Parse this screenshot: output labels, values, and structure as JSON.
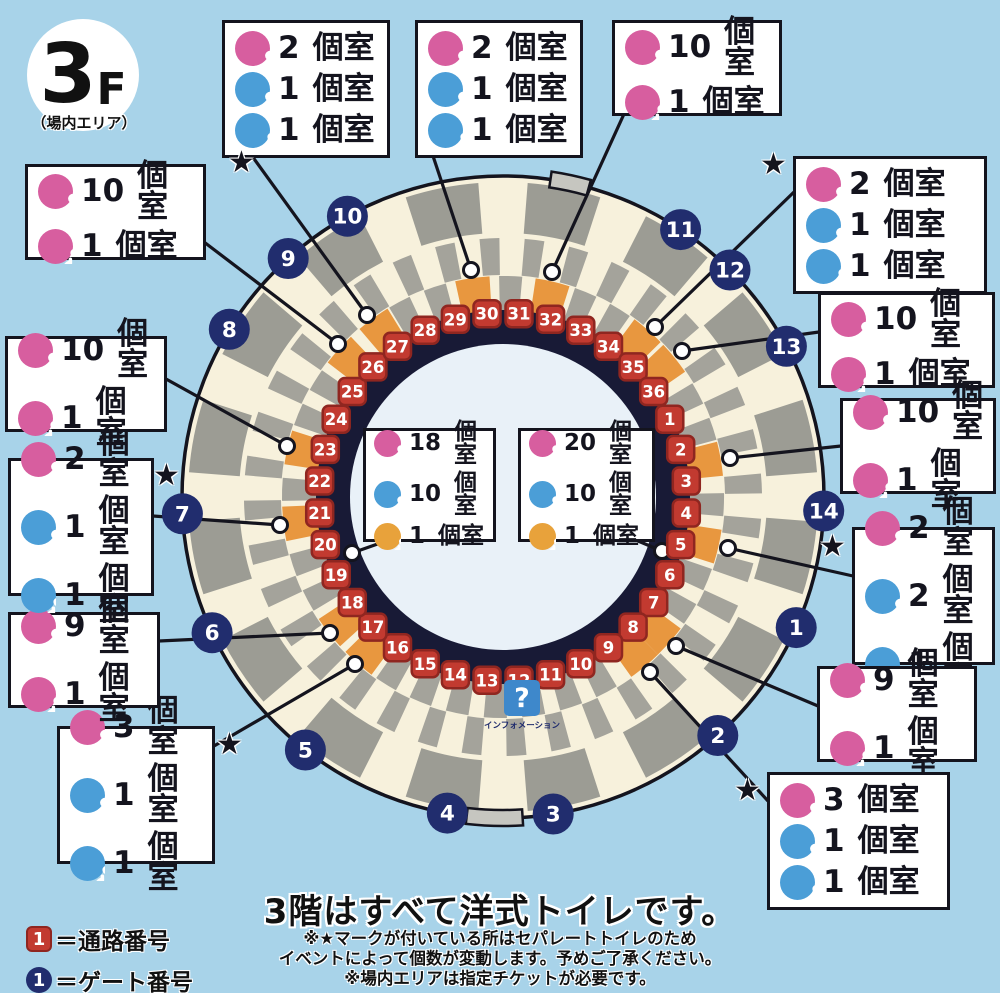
{
  "colors": {
    "background": "#A8D3E9",
    "cream": "#F7F1DC",
    "gray_outer": "#9C9C94",
    "gray_inner": "#A4A39B",
    "navy_ring": "#181A36",
    "field": "#E9F1F8",
    "red": "#C23A30",
    "red_dark": "#8F2620",
    "gate_navy": "#212D6E",
    "pink": "#D75E9F",
    "blue": "#4B9ED7",
    "orange": "#E8A23B",
    "orange_wedge": "#E8973F",
    "line": "#14141E",
    "info_blue": "#3E88CB",
    "notch": "#C6C6C0"
  },
  "floor": {
    "number": "3",
    "suffix": "F",
    "area": "（場内エリア）"
  },
  "unit": "個室",
  "toilets": [
    {
      "id": "b1",
      "star": true,
      "wheelchair_color": "blue",
      "rows": [
        {
          "type": "female",
          "count": "2"
        },
        {
          "type": "male",
          "count": "1"
        },
        {
          "type": "wheelchair",
          "count": "1"
        }
      ]
    },
    {
      "id": "b2",
      "star": false,
      "wheelchair_color": "blue",
      "rows": [
        {
          "type": "female",
          "count": "2"
        },
        {
          "type": "male",
          "count": "1"
        },
        {
          "type": "wheelchair",
          "count": "1"
        }
      ]
    },
    {
      "id": "b3",
      "star": false,
      "wheelchair_color": "pink",
      "rows": [
        {
          "type": "female",
          "count": "10"
        },
        {
          "type": "wheelchair",
          "count": "1"
        }
      ]
    },
    {
      "id": "b4",
      "star": true,
      "wheelchair_color": "blue",
      "rows": [
        {
          "type": "female",
          "count": "2"
        },
        {
          "type": "male",
          "count": "1"
        },
        {
          "type": "wheelchair",
          "count": "1"
        }
      ]
    },
    {
      "id": "b5",
      "star": false,
      "wheelchair_color": "pink",
      "rows": [
        {
          "type": "female",
          "count": "10"
        },
        {
          "type": "wheelchair",
          "count": "1"
        }
      ]
    },
    {
      "id": "b6",
      "star": false,
      "wheelchair_color": "pink",
      "rows": [
        {
          "type": "female",
          "count": "10"
        },
        {
          "type": "wheelchair",
          "count": "1"
        }
      ]
    },
    {
      "id": "b7",
      "star": true,
      "wheelchair_color": "blue",
      "rows": [
        {
          "type": "female",
          "count": "2"
        },
        {
          "type": "male",
          "count": "2"
        },
        {
          "type": "wheelchair",
          "count": "1"
        }
      ]
    },
    {
      "id": "b8",
      "star": false,
      "wheelchair_color": "pink",
      "rows": [
        {
          "type": "female",
          "count": "9"
        },
        {
          "type": "wheelchair",
          "count": "1"
        }
      ]
    },
    {
      "id": "b9",
      "star": true,
      "wheelchair_color": "blue",
      "rows": [
        {
          "type": "female",
          "count": "3"
        },
        {
          "type": "male",
          "count": "1"
        },
        {
          "type": "wheelchair",
          "count": "1"
        }
      ]
    },
    {
      "id": "b10",
      "star": true,
      "wheelchair_color": "blue",
      "rows": [
        {
          "type": "female",
          "count": "3"
        },
        {
          "type": "male",
          "count": "1"
        },
        {
          "type": "wheelchair",
          "count": "1"
        }
      ]
    },
    {
      "id": "b11",
      "star": false,
      "wheelchair_color": "pink",
      "rows": [
        {
          "type": "female",
          "count": "9"
        },
        {
          "type": "wheelchair",
          "count": "1"
        }
      ]
    },
    {
      "id": "b12",
      "star": true,
      "wheelchair_color": "blue",
      "rows": [
        {
          "type": "female",
          "count": "2"
        },
        {
          "type": "male",
          "count": "1"
        },
        {
          "type": "wheelchair",
          "count": "1"
        }
      ]
    },
    {
      "id": "b13",
      "star": false,
      "wheelchair_color": "pink",
      "rows": [
        {
          "type": "female",
          "count": "10"
        },
        {
          "type": "wheelchair",
          "count": "1"
        }
      ]
    },
    {
      "id": "b14",
      "star": false,
      "wheelchair_color": "pink",
      "rows": [
        {
          "type": "female",
          "count": "10"
        },
        {
          "type": "wheelchair",
          "count": "1"
        }
      ]
    },
    {
      "id": "c1",
      "star": false,
      "small": true,
      "wheelchair_color": "orange",
      "rows": [
        {
          "type": "female",
          "count": "18"
        },
        {
          "type": "male",
          "count": "10"
        },
        {
          "type": "wheelchair",
          "count": "1"
        }
      ]
    },
    {
      "id": "c2",
      "star": false,
      "small": true,
      "wheelchair_color": "orange",
      "rows": [
        {
          "type": "female",
          "count": "20"
        },
        {
          "type": "male",
          "count": "10"
        },
        {
          "type": "wheelchair",
          "count": "1"
        }
      ]
    }
  ],
  "aisles": [
    "1",
    "2",
    "3",
    "4",
    "5",
    "6",
    "7",
    "8",
    "9",
    "10",
    "11",
    "12",
    "13",
    "14",
    "15",
    "16",
    "17",
    "18",
    "19",
    "20",
    "21",
    "22",
    "23",
    "24",
    "25",
    "26",
    "27",
    "28",
    "29",
    "30",
    "31",
    "32",
    "33",
    "34",
    "35",
    "36"
  ],
  "gates": [
    "1",
    "2",
    "3",
    "4",
    "5",
    "6",
    "7",
    "8",
    "9",
    "10",
    "11",
    "12",
    "13",
    "14"
  ],
  "info": {
    "symbol": "?",
    "label": "インフォメーション"
  },
  "legend": [
    {
      "marker": "aisle",
      "sample": "1",
      "label": "＝通路番号"
    },
    {
      "marker": "gate",
      "sample": "1",
      "label": "＝ゲート番号"
    }
  ],
  "footer": {
    "heading": "3階はすべて洋式トイレです。",
    "notes": [
      "※★マークが付いている所はセパレートトイレのため",
      "イベントによって個数が変動します。予めご了承ください。",
      "※場内エリアは指定チケットが必要です。"
    ]
  }
}
